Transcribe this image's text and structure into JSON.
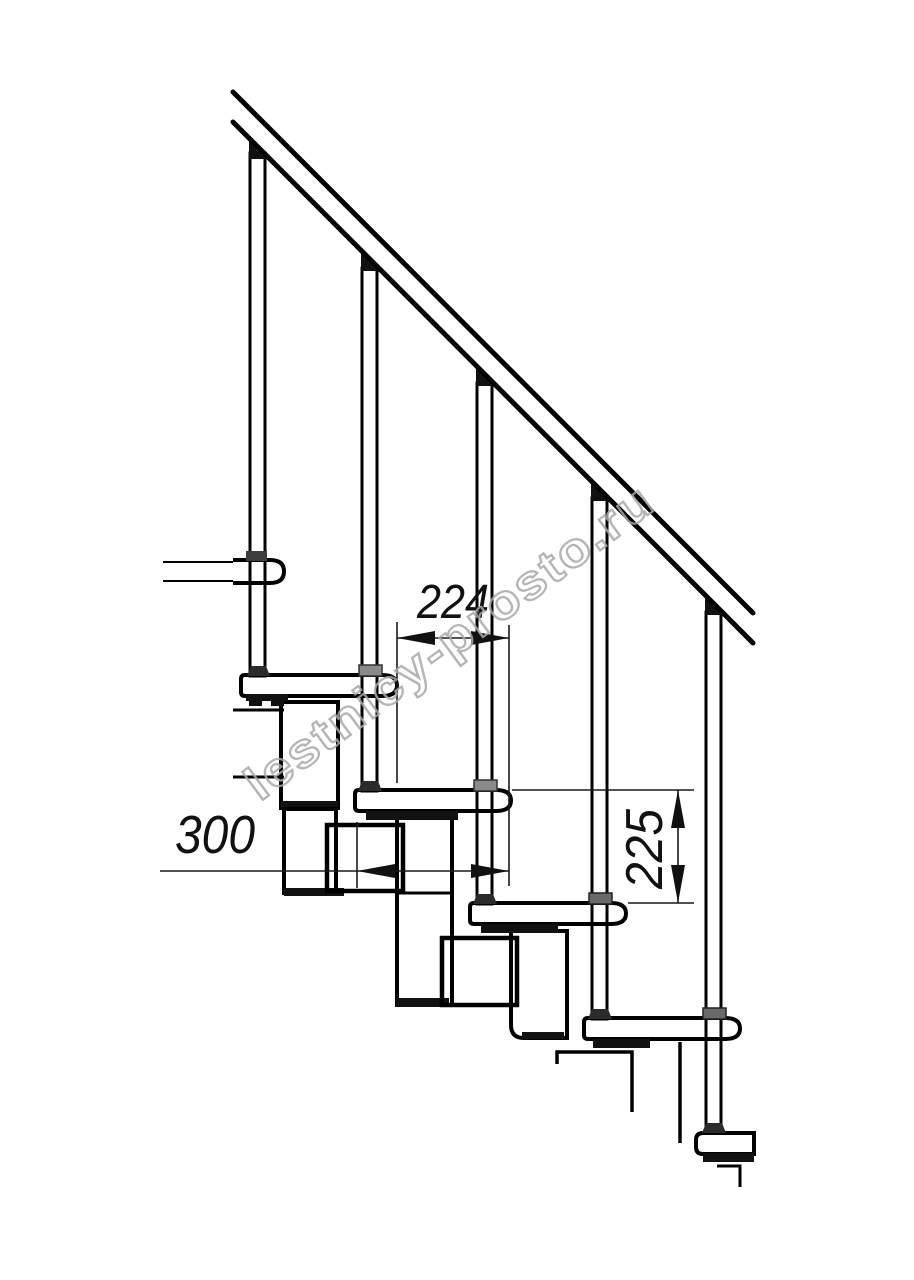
{
  "drawing": {
    "dimensions": {
      "step_depth": "224",
      "tread_length": "300",
      "step_rise": "225"
    },
    "watermark": {
      "text": "lestnicy-prosto.ru",
      "color": "#a9a9a9"
    },
    "colors": {
      "line": "#000000",
      "dim_line": "#1a1a1a",
      "background": "#ffffff"
    }
  }
}
